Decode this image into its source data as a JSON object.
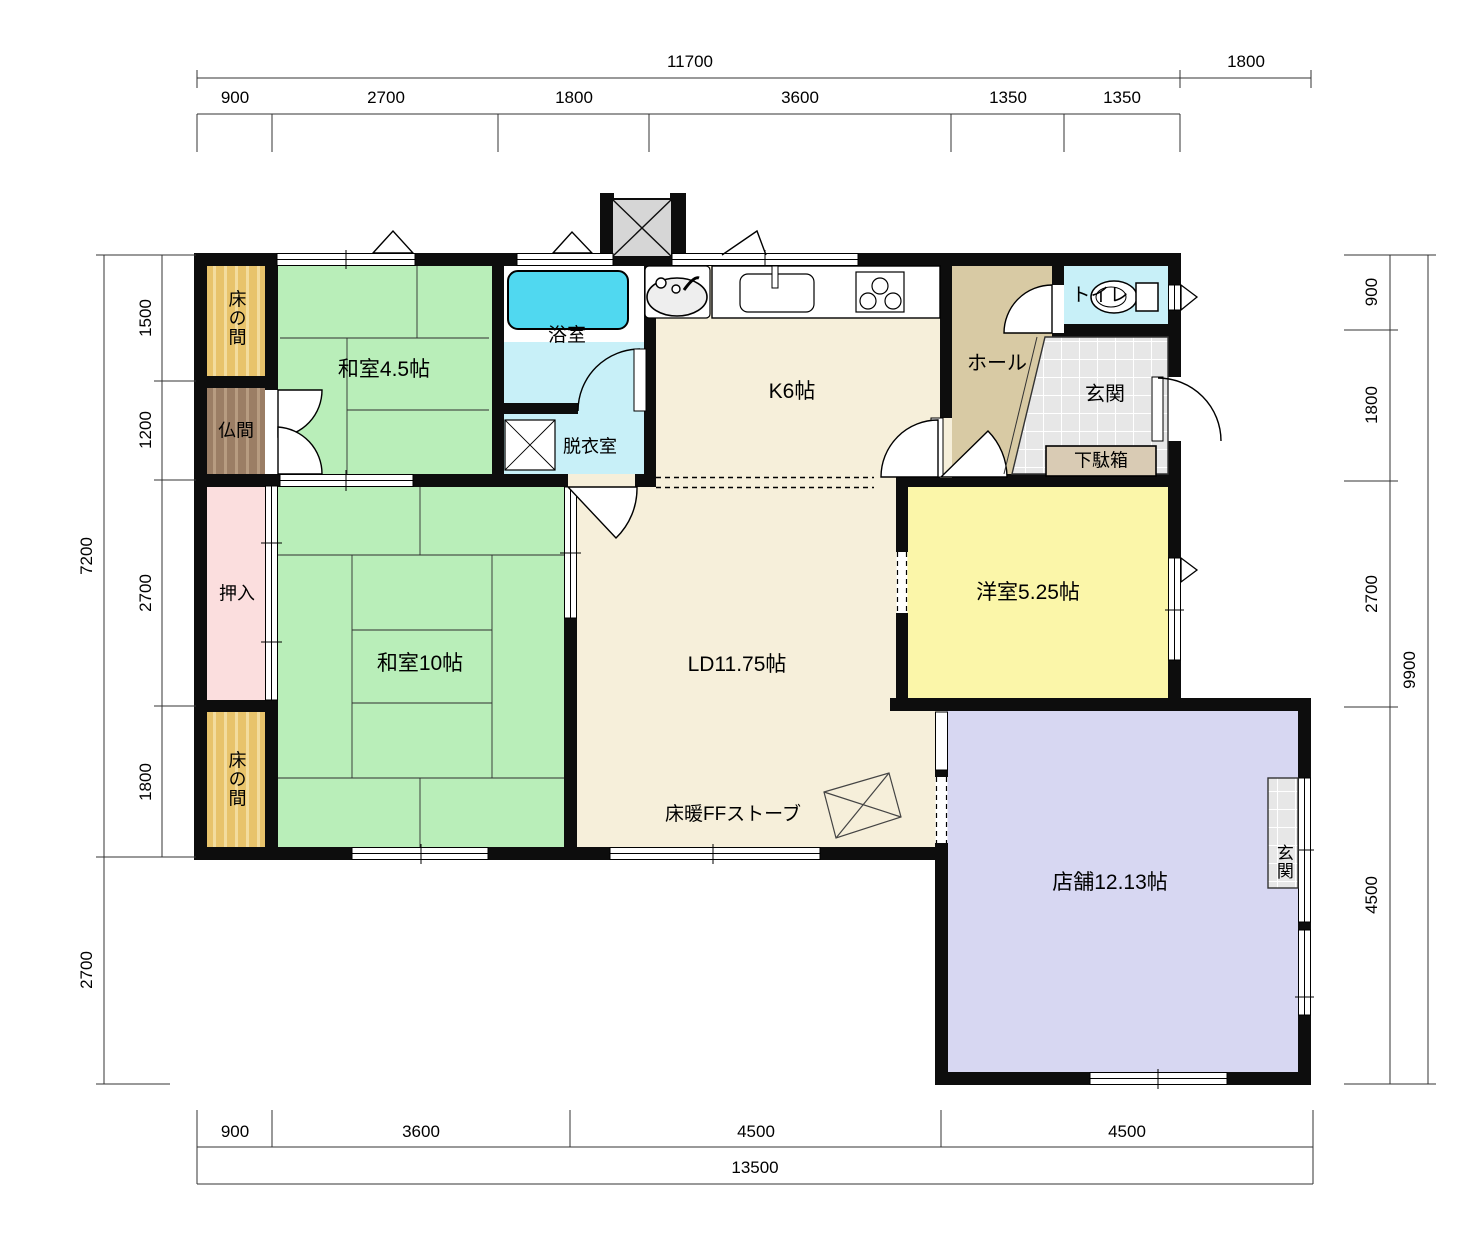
{
  "drawing": {
    "type": "japanese-floor-plan"
  },
  "rooms": {
    "tokonoma_top": "床の間",
    "washitsu_45": "和室4.5帖",
    "butsuma": "仏間",
    "bathroom": "浴室",
    "dressing_room": "脱衣室",
    "kitchen": "K6帖",
    "hall": "ホール",
    "toilet": "トイレ",
    "entrance": "玄関",
    "shoe_cabinet": "下駄箱",
    "closet": "押入",
    "washitsu_10": "和室10帖",
    "tokonoma_bottom": "床の間",
    "living_dining": "LD11.75帖",
    "western_room": "洋室5.25帖",
    "shop": "店舗12.13帖",
    "shop_entrance": "玄関",
    "floor_heater": "床暖FFストーブ"
  },
  "dimensions": {
    "top": {
      "total": "11700",
      "annex": "1800",
      "segments": [
        "900",
        "2700",
        "1800",
        "3600",
        "1350",
        "1350"
      ]
    },
    "bottom": {
      "total": "13500",
      "segments": [
        "900",
        "3600",
        "4500",
        "4500"
      ]
    },
    "left": {
      "total": "7200",
      "lower": "2700",
      "segments": [
        "1500",
        "1200",
        "2700",
        "1800"
      ]
    },
    "right": {
      "total": "9900",
      "segments": [
        "900",
        "1800",
        "2700",
        "4500"
      ]
    }
  },
  "colors": {
    "tatami": "#b9eeb9",
    "wood_floor": "#f6efda",
    "hall": "#d8caa4",
    "western_room": "#fbf6a9",
    "shop": "#d7d7f2",
    "closet": "#fbdede",
    "wet_room": "#c8f0f8",
    "bathtub": "#50d8f0",
    "tokonoma": "#e8c36b",
    "butsuma": "#9b7e65",
    "tile": "#e7e7e7",
    "wall": "#0d0d0d"
  }
}
